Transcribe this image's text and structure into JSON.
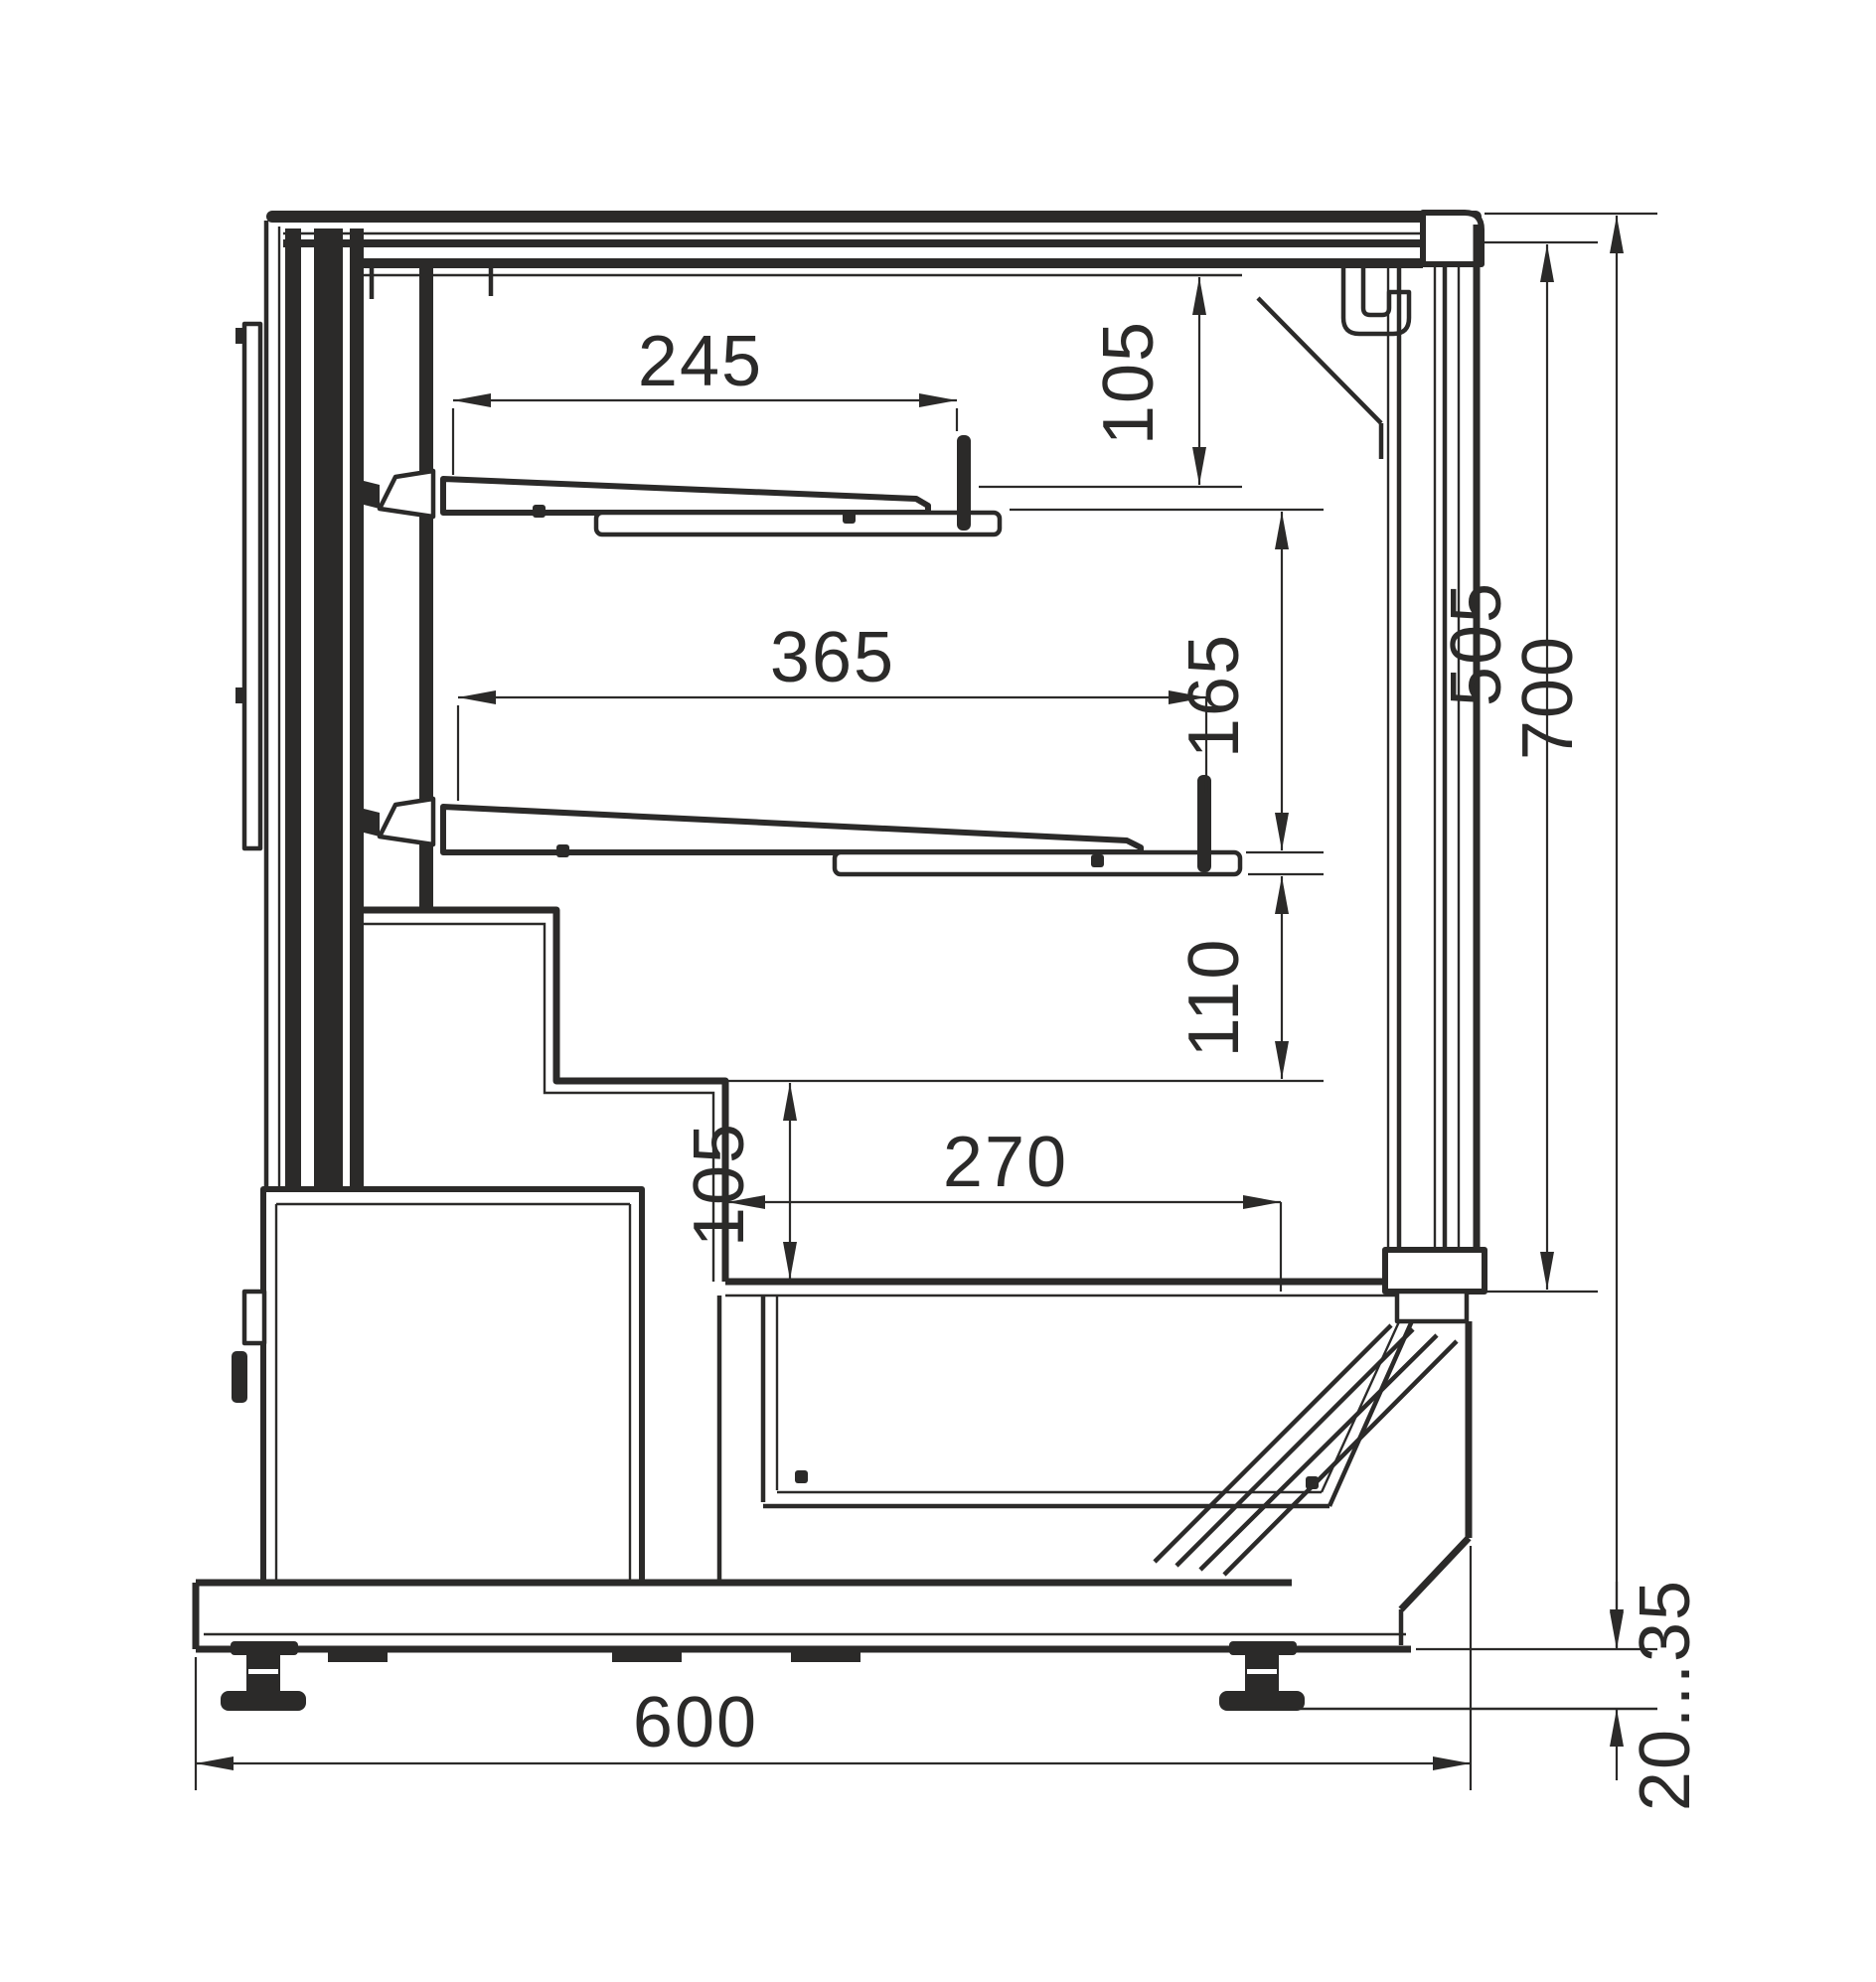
{
  "meta": {
    "type": "technical-drawing",
    "view": "side-cross-section of refrigerated display case",
    "units": "mm",
    "background": "#ffffff",
    "line_color": "#2b2a29"
  },
  "dims": {
    "top_shelf_depth": {
      "label": "245",
      "value_mm": 245,
      "orientation": "horizontal"
    },
    "canopy_to_top_shelf": {
      "label": "105",
      "value_mm": 105,
      "orientation": "vertical"
    },
    "mid_shelf_depth": {
      "label": "365",
      "value_mm": 365,
      "orientation": "horizontal"
    },
    "top_to_mid_clearance": {
      "label": "165",
      "value_mm": 165,
      "orientation": "vertical"
    },
    "mid_to_deck_clearance": {
      "label": "110",
      "value_mm": 110,
      "orientation": "vertical"
    },
    "deck_step_height": {
      "label": "105",
      "value_mm": 105,
      "orientation": "vertical"
    },
    "well_depth": {
      "label": "270",
      "value_mm": 270,
      "orientation": "horizontal"
    },
    "front_opening_height": {
      "label": "505",
      "value_mm": 505,
      "orientation": "vertical"
    },
    "overall_height": {
      "label": "700",
      "value_mm": 700,
      "orientation": "vertical"
    },
    "overall_depth": {
      "label": "600",
      "value_mm": 600,
      "orientation": "horizontal"
    },
    "foot_adjust_range": {
      "label": "20...35",
      "orientation": "vertical"
    }
  }
}
